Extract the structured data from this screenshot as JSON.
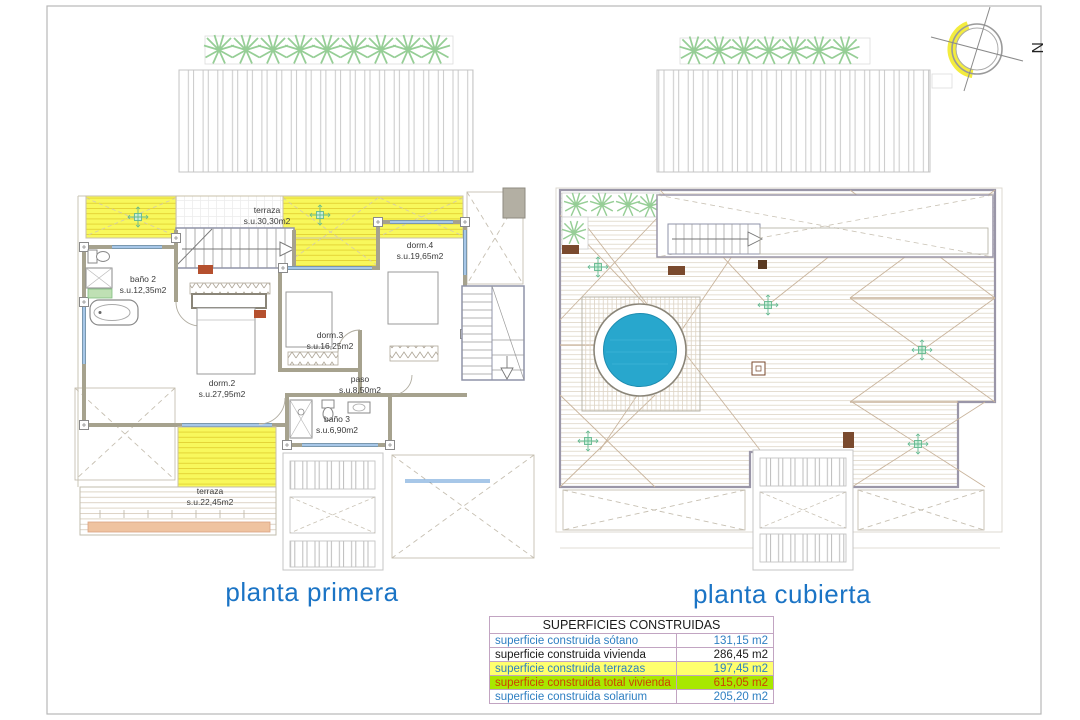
{
  "compass": {
    "label": "N"
  },
  "titles": {
    "left": "planta primera",
    "right": "planta cubierta"
  },
  "left_plan": {
    "rooms": [
      {
        "label": "terraza",
        "area": "s.u.30,30m2"
      },
      {
        "label": "baño 2",
        "area": "s.u.12,35m2"
      },
      {
        "label": "dorm.4",
        "area": "s.u.19,65m2"
      },
      {
        "label": "dorm.3",
        "area": "s.u.16,25m2"
      },
      {
        "label": "dorm.2",
        "area": "s.u.27,95m2"
      },
      {
        "label": "paso",
        "area": "s.u.8,50m2"
      },
      {
        "label": "baño 3",
        "area": "s.u.6,90m2"
      },
      {
        "label": "terraza",
        "area": "s.u.22,45m2"
      }
    ]
  },
  "table": {
    "title": "SUPERFICIES CONSTRUIDAS",
    "rows": [
      {
        "label": "superficie construida sótano",
        "value": "131,15 m2",
        "bg": "#ffffff",
        "color": "#2e7fc2"
      },
      {
        "label": "superficie construida vivienda",
        "value": "286,45 m2",
        "bg": "#ffffff",
        "color": "#1a1a1a"
      },
      {
        "label": "superficie construida terrazas",
        "value": "197,45 m2",
        "bg": "#ffff6e",
        "color": "#2e7fc2"
      },
      {
        "label": "superficie construida total vivienda",
        "value": "615,05 m2",
        "bg": "#a8e800",
        "color": "#cc4400"
      },
      {
        "label": "superficie construida solarium",
        "value": "205,20 m2",
        "bg": "#ffffff",
        "color": "#2e7fc2"
      }
    ]
  },
  "colors": {
    "title_blue": "#1b74c5",
    "pool_blue": "#28a7cd",
    "terrace_yellow": "#f8f85c",
    "highlight_yellow": "#ffff6e",
    "highlight_green": "#a8e800",
    "value_blue": "#2e7fc2",
    "total_red": "#cc4400"
  }
}
